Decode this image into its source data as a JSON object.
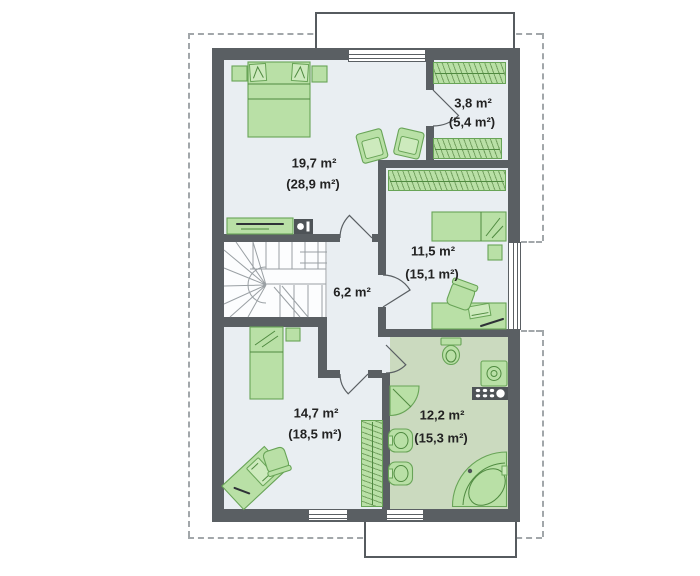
{
  "plan": {
    "title": "attic-floor-plan",
    "rooms": [
      {
        "name": "bedroom-main",
        "area": "19,7 m²",
        "area_roof": "(28,9 m²)"
      },
      {
        "name": "wardrobe-room",
        "area": "3,8 m²",
        "area_roof": "(5,4 m²)"
      },
      {
        "name": "bedroom-right",
        "area": "11,5 m²",
        "area_roof": "(15,1 m²)"
      },
      {
        "name": "hallway",
        "area": "6,2 m²",
        "area_roof": ""
      },
      {
        "name": "bedroom-bottom",
        "area": "14,7 m²",
        "area_roof": "(18,5 m²)"
      },
      {
        "name": "bathroom",
        "area": "12,2 m²",
        "area_roof": "(15,3 m²)"
      }
    ],
    "colors": {
      "wall": "#5a5f63",
      "floor": "#e9eef2",
      "bathroom_floor": "#cbdabf",
      "furniture_fill": "#b9e0a6",
      "furniture_stroke": "#68a457",
      "roof_outline_dash": "#a2a7aa",
      "appliance_dark": "#4e5357",
      "label_text": "#222222"
    }
  }
}
